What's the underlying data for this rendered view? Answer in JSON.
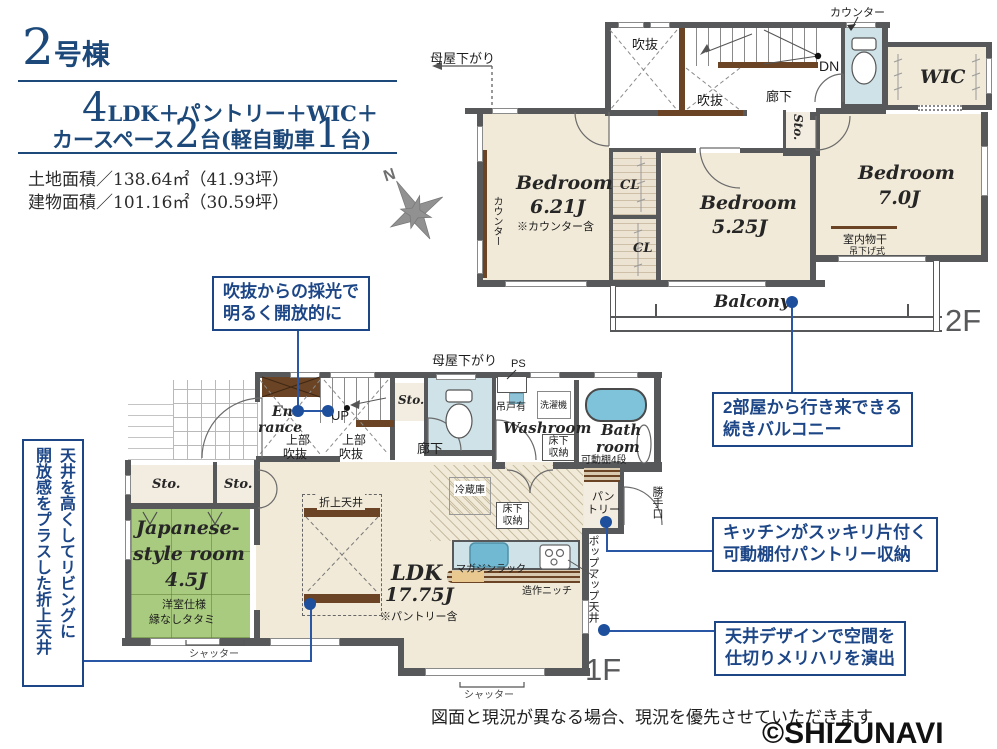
{
  "header": {
    "unit_big": "2",
    "unit_suffix": "号棟",
    "plan_big": "4",
    "plan_rest": "LDK＋パントリー＋WIC＋",
    "plan2_pre": "カースペース",
    "plan2_num1": "2",
    "plan2_mid": "台(軽自動車",
    "plan2_num2": "1",
    "plan2_end": "台)",
    "land_area": "土地面積／138.64㎡（41.93坪）",
    "building_area": "建物面積／101.16㎡（30.59坪）"
  },
  "compass": {
    "north": "N"
  },
  "floor2": {
    "floor_label": "2F",
    "moya_sagari": "母屋下がり",
    "counter_top": "カウンター",
    "counter_side": "カウンター",
    "void1": "吹抜",
    "void2": "吹抜",
    "dn": "DN",
    "hallway": "廊下",
    "wic": "WIC",
    "sto": "Sto.",
    "cl1": "CL",
    "cl2": "CL",
    "bedroom1": {
      "name": "Bedroom",
      "size": "6.21J",
      "note": "※カウンター含"
    },
    "bedroom2": {
      "name": "Bedroom",
      "size": "5.25J"
    },
    "bedroom3": {
      "name": "Bedroom",
      "size": "7.0J"
    },
    "drying": "室内物干",
    "drying_sub": "吊下げ式",
    "balcony": "Balcony"
  },
  "floor1": {
    "floor_label": "1F",
    "moya_sagari": "母屋下がり",
    "entrance1": "Ent",
    "entrance2": "rance",
    "up": "UP",
    "void_upper1a": "上部",
    "void_upper1b": "吹抜",
    "void_upper2a": "上部",
    "void_upper2b": "吹抜",
    "sto_hall": "Sto.",
    "hallway": "廊下",
    "ps": "PS",
    "hanging_cabinet": "吊戸有",
    "washer": "洗濯機",
    "washroom": "Washroom",
    "underfloor_wash1": "床下",
    "underfloor_wash2": "収納",
    "bath1": "Bath",
    "bath2": "room",
    "shelf_note": "可動棚4段",
    "sto1": "Sto.",
    "sto2": "Sto.",
    "jp_room1": "Japanese-",
    "jp_room2": "style room",
    "jp_room3": "4.5J",
    "jp_note1": "洋室仕様",
    "jp_note2": "縁なしタタミ",
    "shutter1": "シャッター",
    "shutter2": "シャッター",
    "coffered": "折上天井",
    "fridge": "冷蔵庫",
    "underfloor_kit1": "床下",
    "underfloor_kit2": "収納",
    "magazine": "マガジンラック",
    "niche": "造作ニッチ",
    "pantry1": "パン",
    "pantry2": "トリー",
    "backdoor": "勝手口",
    "popup": "ポップアップ天井",
    "ldk": "LDK",
    "ldk_size": "17.75J",
    "ldk_note": "※パントリー含"
  },
  "callouts": {
    "light1": "吹抜からの採光で",
    "light2": "明るく開放的に",
    "balcony1": "2部屋から行き来できる",
    "balcony2": "続きバルコニー",
    "pantry1": "キッチンがスッキリ片付く",
    "pantry2": "可動棚付パントリー収納",
    "ceiling1": "天井デザインで空間を",
    "ceiling2": "仕切りメリハリを演出",
    "coffered1": "天井を高くしてリビングに",
    "coffered2": "開放感をプラスした折上天井"
  },
  "footer": {
    "disclaimer": "図面と現況が異なる場合、現況を優先させていただきます",
    "watermark": "©SHIZUNAVI"
  },
  "colors": {
    "navy": "#1c4979",
    "callout_blue": "#1d4687",
    "connector_blue": "#2a57a5",
    "wall_gray": "#57585a",
    "room_cream": "#f1ead8",
    "tatami_green": "#a9cb7f",
    "water_blue": "#cfe2e8",
    "tub_blue": "#7fc3da",
    "wood_brown": "#6a4424"
  }
}
